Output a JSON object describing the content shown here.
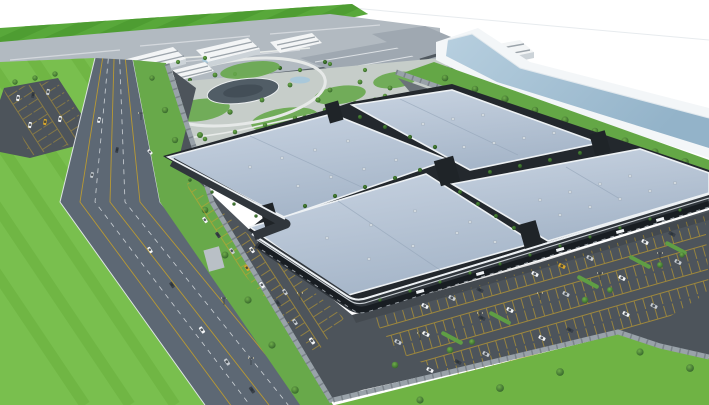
{
  "scene": {
    "description": "Aerial 3D architectural rendering of a logistics and retail park: four large blue-gray flat-roof warehouse blocks in a 2x2 grid with landscaped spines, a front parking lot full of cars, an office campus with a circular park, a perimeter wall, a multi-lane highway beside a green field, and a water canal along the back edge",
    "warehouse_blocks": 4,
    "parking_lots": 3,
    "has_canal": true,
    "has_highway": true,
    "has_campus_park": true
  },
  "colors": {
    "sky": "#ffffff",
    "horizon": "#e7ebee",
    "farField": "#58a83a",
    "farFieldStripe": "#4c9a31",
    "industrialRoof": "#b2bac1",
    "industrialFacade": "#59626a",
    "shedRoof": "#9fa8b1",
    "campusGround": "#c6cdc9",
    "lawn": "#68a94d",
    "path": "#e8ebe9",
    "pond": "#a9c8da",
    "ringRoad": "#e6e9e8",
    "pavilionRoof": "#515d66",
    "pavilionInner": "#434e57",
    "officeWhite": "#f3f5f6",
    "officeWindow": "#64707a",
    "officeShade": "#ccd3d8",
    "bank": "#f3f6f8",
    "water": "#a3c0d4",
    "canalGreen": "#64a746",
    "wall": "#99a2a9",
    "wallPost": "#7b838a",
    "serviceRoad": "#6a7278",
    "asphalt": "#4d545b",
    "parkLine": "#caa32b",
    "island": "#5f9e44",
    "roofEdge": "#edf1f4",
    "roofRidge": "#93a4b8",
    "complexBase": "#23282d",
    "facadeDark": "#30363c",
    "glassDark": "#181d22",
    "facadeAccent": "#d8dee2",
    "tower": "#1f2428",
    "highway": "#5d6874",
    "laneYellow": "#c9a227",
    "laneWhite": "#e8ecef",
    "leftField": "#79bf4e",
    "leftFieldStripe": "#6eb443",
    "verge": "#68a94a",
    "grassBR": "#6fb344",
    "vent": "#dfe5ea",
    "carWhite": "#f4f6f8",
    "carSilver": "#c7ccd1",
    "carDark": "#394049",
    "carYellow": "#d8a62a"
  }
}
